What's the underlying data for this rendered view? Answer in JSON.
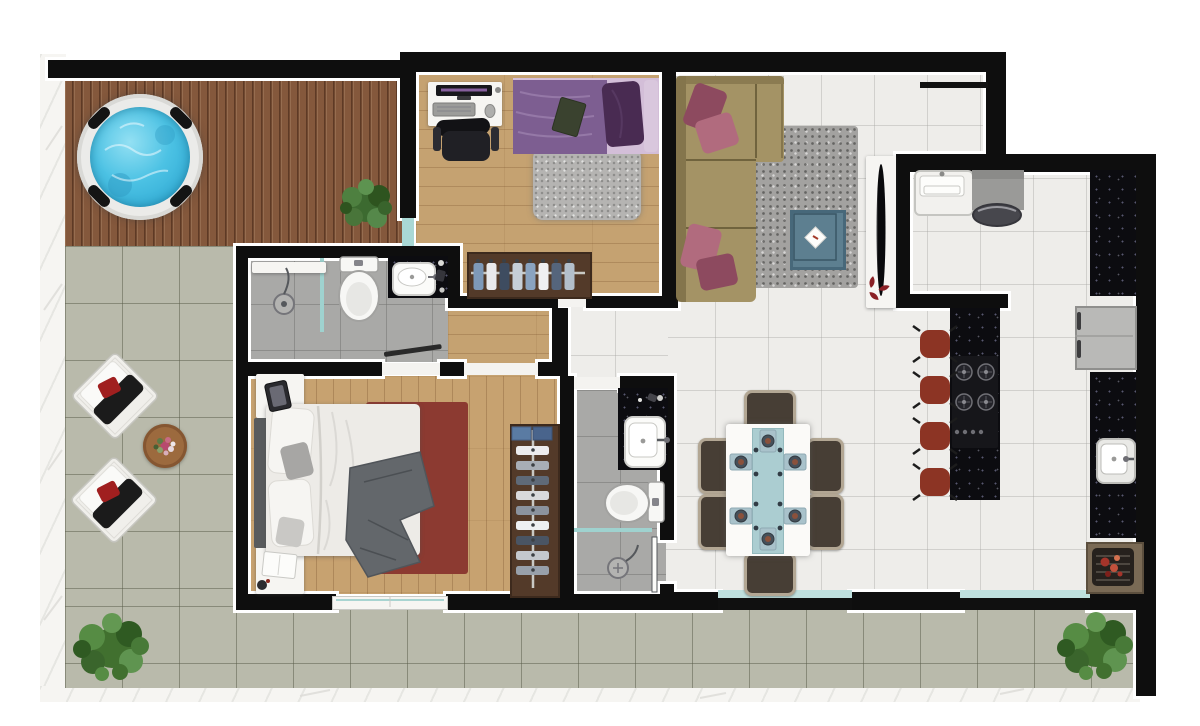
{
  "canvas": {
    "w": 1200,
    "h": 726,
    "background": "#ffffff"
  },
  "palette": {
    "wall": "#0e0e0e",
    "wall_outline": "#ffffff",
    "deck_wood": "#84583c",
    "light_wood": "#c5a271",
    "patio_tile": "#b9baab",
    "white_tile": "#eeedea",
    "gray_tile": "#a9a9a7",
    "granite_counter": "#0c0c10",
    "hot_tub_water": "#4cc2e4",
    "glass_teal": "#9fd2cf",
    "sofa_tan": "#a49365",
    "cushion_maroon": "#8d4a5f",
    "stool_red": "#8c3424",
    "master_rug_red": "#8c3a31",
    "duvet_purple": "#7d5e91",
    "dining_chair_brown": "#473e35",
    "plant_green": "#41702f",
    "coffee_table_blue": "#5d7f90"
  },
  "floors": [
    {
      "n": "left-sill",
      "x": 40,
      "y": 54,
      "w": 26,
      "h": 648,
      "c": "sill"
    },
    {
      "n": "bottom-sill",
      "x": 40,
      "y": 686,
      "w": 1100,
      "h": 16,
      "c": "sill"
    },
    {
      "n": "deck-floor",
      "x": 65,
      "y": 78,
      "w": 338,
      "h": 168,
      "c": "deck"
    },
    {
      "n": "patio-left-floor",
      "x": 65,
      "y": 246,
      "w": 172,
      "h": 362,
      "c": "patio"
    },
    {
      "n": "patio-bottom-floor",
      "x": 65,
      "y": 606,
      "w": 1071,
      "h": 82,
      "c": "patio"
    },
    {
      "n": "living-kitchen-floor",
      "x": 662,
      "y": 72,
      "w": 474,
      "h": 522,
      "c": "tileW"
    },
    {
      "n": "outside-corner",
      "x": 1006,
      "y": 40,
      "w": 154,
      "h": 114,
      "f": "#ffffff"
    },
    {
      "n": "bedroom1-floor",
      "x": 416,
      "y": 72,
      "w": 246,
      "h": 232,
      "c": "woodH"
    },
    {
      "n": "hall-floor",
      "x": 448,
      "y": 296,
      "w": 114,
      "h": 80,
      "c": "woodH"
    },
    {
      "n": "living-strip-floor",
      "x": 562,
      "y": 302,
      "w": 106,
      "h": 76,
      "c": "tileW"
    },
    {
      "n": "bath1-floor",
      "x": 248,
      "y": 258,
      "w": 200,
      "h": 104,
      "c": "tileG"
    },
    {
      "n": "bath2-floor",
      "x": 574,
      "y": 390,
      "w": 92,
      "h": 204,
      "c": "tileG"
    },
    {
      "n": "master-bedroom-floor",
      "x": 248,
      "y": 376,
      "w": 312,
      "h": 218,
      "c": "woodV"
    }
  ],
  "walls": [
    {
      "n": "deck-top-wall",
      "x": 48,
      "y": 60,
      "w": 360,
      "h": 18
    },
    {
      "n": "main-top-wall",
      "x": 400,
      "y": 52,
      "w": 606,
      "h": 20
    },
    {
      "n": "upper-right-wall",
      "x": 986,
      "y": 52,
      "w": 20,
      "h": 112
    },
    {
      "n": "kitchen-top-wall",
      "x": 896,
      "y": 154,
      "w": 260,
      "h": 18
    },
    {
      "n": "right-outer-wall",
      "x": 1136,
      "y": 154,
      "w": 20,
      "h": 542
    },
    {
      "n": "deck-divider-wall",
      "x": 400,
      "y": 60,
      "w": 16,
      "h": 158
    },
    {
      "n": "bath1-top-wall",
      "x": 236,
      "y": 246,
      "w": 224,
      "h": 12
    },
    {
      "n": "bath1-left-wall",
      "x": 236,
      "y": 246,
      "w": 12,
      "h": 128
    },
    {
      "n": "bath1-right-wall",
      "x": 448,
      "y": 246,
      "w": 12,
      "h": 62
    },
    {
      "n": "closet-wall-a",
      "x": 448,
      "y": 296,
      "w": 110,
      "h": 12
    },
    {
      "n": "closet-wall-b",
      "x": 586,
      "y": 296,
      "w": 92,
      "h": 12
    },
    {
      "n": "hall-right-wall",
      "x": 552,
      "y": 308,
      "w": 16,
      "h": 68
    },
    {
      "n": "master-top-wall-a",
      "x": 236,
      "y": 362,
      "w": 146,
      "h": 14
    },
    {
      "n": "master-top-wall-b",
      "x": 440,
      "y": 362,
      "w": 24,
      "h": 14
    },
    {
      "n": "master-top-wall-c",
      "x": 538,
      "y": 362,
      "w": 26,
      "h": 14
    },
    {
      "n": "master-left-wall",
      "x": 236,
      "y": 362,
      "w": 12,
      "h": 248
    },
    {
      "n": "master-bottom-wall-a",
      "x": 236,
      "y": 594,
      "w": 100,
      "h": 16
    },
    {
      "n": "master-bottom-wall-b",
      "x": 446,
      "y": 594,
      "w": 120,
      "h": 16
    },
    {
      "n": "bath2-left-wall",
      "x": 560,
      "y": 376,
      "w": 14,
      "h": 234
    },
    {
      "n": "bath2-top-wall",
      "x": 620,
      "y": 376,
      "w": 54,
      "h": 14
    },
    {
      "n": "bath2-right-wall",
      "x": 660,
      "y": 376,
      "w": 14,
      "h": 164
    },
    {
      "n": "bath2-right-stub",
      "x": 660,
      "y": 584,
      "w": 14,
      "h": 26
    },
    {
      "n": "bath2-bottom-wall",
      "x": 574,
      "y": 594,
      "w": 100,
      "h": 16
    },
    {
      "n": "bedroom1-right-wall",
      "x": 662,
      "y": 52,
      "w": 14,
      "h": 252
    },
    {
      "n": "kitchen-left-wall",
      "x": 896,
      "y": 154,
      "w": 14,
      "h": 154
    },
    {
      "n": "kitchen-nook-wall",
      "x": 896,
      "y": 294,
      "w": 112,
      "h": 14
    },
    {
      "n": "living-bottom-wall-a",
      "x": 662,
      "y": 592,
      "w": 58,
      "h": 18
    },
    {
      "n": "living-bottom-wall-b",
      "x": 850,
      "y": 592,
      "w": 112,
      "h": 18
    },
    {
      "n": "living-bottom-wall-c",
      "x": 1088,
      "y": 592,
      "w": 52,
      "h": 18
    }
  ],
  "glass": [
    {
      "n": "upper-ledge",
      "x": 920,
      "y": 82,
      "w": 68,
      "h": 6,
      "f": "#121212"
    },
    {
      "n": "deck-glass-door",
      "x": 402,
      "y": 218,
      "w": 12,
      "h": 28,
      "f": "#a9d8d5"
    },
    {
      "n": "slider-track-1",
      "x": 718,
      "y": 598,
      "w": 134,
      "h": 12,
      "f": "#101010"
    },
    {
      "n": "slider-glass-1",
      "x": 718,
      "y": 590,
      "w": 134,
      "h": 8,
      "f": "#bfe0de"
    },
    {
      "n": "slider-track-2",
      "x": 960,
      "y": 598,
      "w": 130,
      "h": 12,
      "f": "#101010"
    },
    {
      "n": "slider-glass-2",
      "x": 960,
      "y": 590,
      "w": 130,
      "h": 8,
      "f": "#bfe0de"
    },
    {
      "n": "master-window",
      "x": 332,
      "y": 596,
      "w": 114,
      "h": 12,
      "f": "#f6f5f2",
      "b": "1px solid #c9c9c5"
    },
    {
      "n": "bath1-shower-glass",
      "x": 320,
      "y": 258,
      "w": 4,
      "h": 74,
      "f": "#9fd2cf"
    },
    {
      "n": "bath2-shower-glass",
      "x": 574,
      "y": 528,
      "w": 78,
      "h": 4,
      "f": "#9fd2cf"
    },
    {
      "n": "bedroom1-door-threshold",
      "x": 558,
      "y": 297,
      "w": 28,
      "h": 10,
      "f": "#f4f3f0"
    },
    {
      "n": "master-door-threshold",
      "x": 464,
      "y": 363,
      "w": 74,
      "h": 12,
      "f": "#f4f3f0"
    },
    {
      "n": "bath1-door-threshold",
      "x": 382,
      "y": 363,
      "w": 58,
      "h": 12,
      "f": "#f4f3f0"
    },
    {
      "n": "bath2-door-threshold",
      "x": 574,
      "y": 377,
      "w": 46,
      "h": 12,
      "f": "#f4f3f0"
    }
  ],
  "furniture": [
    {
      "n": "living-rug",
      "x": 746,
      "y": 126,
      "w": 112,
      "h": 162,
      "c": "rugL"
    },
    {
      "n": "sofa-body",
      "x": 676,
      "y": 76,
      "w": 80,
      "h": 226,
      "f": "#a49365",
      "r": 6
    },
    {
      "n": "sofa-chaise",
      "x": 676,
      "y": 76,
      "w": 108,
      "h": 86,
      "f": "#a49365",
      "r": 4
    },
    {
      "n": "coffee-table",
      "x": 790,
      "y": 210,
      "w": 50,
      "h": 54,
      "f": "#5d7f90",
      "b": "3px solid #47687a"
    },
    {
      "n": "tv-console",
      "x": 866,
      "y": 156,
      "w": 30,
      "h": 152,
      "c": "whitebox"
    },
    {
      "n": "hottub-rim",
      "x": 77,
      "y": 94,
      "w": 126,
      "h": 126,
      "r": "50%",
      "f": "#ebebe9",
      "sh": "0 0 8px rgba(60,60,60,.5), inset 0 0 0 4px #d9d9d6"
    },
    {
      "n": "hottub-water",
      "x": 90,
      "y": 107,
      "w": 100,
      "h": 100,
      "r": "50%",
      "c": "water"
    },
    {
      "n": "desk",
      "x": 428,
      "y": 82,
      "w": 74,
      "h": 44,
      "c": "whitebox"
    },
    {
      "n": "bedroom1-rug",
      "x": 533,
      "y": 148,
      "w": 108,
      "h": 72,
      "c": "rug1"
    },
    {
      "n": "bed1-base",
      "x": 513,
      "y": 78,
      "w": 146,
      "h": 76,
      "f": "#d3bed8"
    },
    {
      "n": "bed1-duvet",
      "x": 513,
      "y": 80,
      "w": 94,
      "h": 74,
      "f": "#7d5e91"
    },
    {
      "n": "bed1-pillow",
      "x": 604,
      "y": 82,
      "w": 38,
      "h": 64,
      "f": "#492b52",
      "r": 7,
      "rot": -5
    },
    {
      "n": "bed1-edge-pillow",
      "x": 644,
      "y": 80,
      "w": 14,
      "h": 72,
      "f": "#d9c7dd",
      "r": 4
    },
    {
      "n": "bedroom1-closet",
      "x": 467,
      "y": 252,
      "w": 121,
      "h": 43,
      "f": "#533a29",
      "b": "2px solid #3d2a1d"
    },
    {
      "n": "bath1-shelf",
      "x": 252,
      "y": 262,
      "w": 74,
      "h": 11,
      "c": "whitebox"
    },
    {
      "n": "bath1-counter",
      "x": 388,
      "y": 256,
      "w": 60,
      "h": 42,
      "c": "granite"
    },
    {
      "n": "bath1-sink",
      "x": 392,
      "y": 262,
      "w": 40,
      "h": 30,
      "f": "#fbfbf9",
      "r": 8,
      "b": "2px solid #cfcfcc"
    },
    {
      "n": "nightstand-1",
      "x": 256,
      "y": 374,
      "w": 48,
      "h": 44,
      "c": "whitebox"
    },
    {
      "n": "nightstand-2",
      "x": 256,
      "y": 546,
      "w": 48,
      "h": 48,
      "c": "whitebox"
    },
    {
      "n": "master-rug",
      "x": 366,
      "y": 402,
      "w": 102,
      "h": 172,
      "f": "#8c3a31",
      "r": 3
    },
    {
      "n": "bed2-headboard",
      "x": 254,
      "y": 418,
      "w": 14,
      "h": 130,
      "f": "#595b5d",
      "r": 2
    },
    {
      "n": "bed2-mattress",
      "x": 266,
      "y": 404,
      "w": 154,
      "h": 152,
      "f": "#edebe7",
      "r": 5,
      "sh": "0 1px 4px rgba(80,80,80,.5)"
    },
    {
      "n": "master-closet",
      "x": 510,
      "y": 424,
      "w": 46,
      "h": 170,
      "f": "#533a29",
      "b": "2px solid #3d2a1d"
    },
    {
      "n": "bath2-counter",
      "x": 618,
      "y": 388,
      "w": 50,
      "h": 82,
      "c": "granite"
    },
    {
      "n": "bath2-sink",
      "x": 624,
      "y": 416,
      "w": 38,
      "h": 48,
      "f": "#fbfbf9",
      "r": 9,
      "b": "2px solid #cfcfcc"
    },
    {
      "n": "dining-chair-top",
      "x": 744,
      "y": 390,
      "w": 46,
      "h": 38,
      "c": "dchair"
    },
    {
      "n": "dining-chair-bottom",
      "x": 744,
      "y": 552,
      "w": 46,
      "h": 38,
      "c": "dchair"
    },
    {
      "n": "dining-chair-left-1",
      "x": 698,
      "y": 438,
      "w": 32,
      "h": 50,
      "c": "dchair"
    },
    {
      "n": "dining-chair-left-2",
      "x": 698,
      "y": 494,
      "w": 32,
      "h": 50,
      "c": "dchair"
    },
    {
      "n": "dining-chair-right-1",
      "x": 806,
      "y": 438,
      "w": 32,
      "h": 50,
      "c": "dchair"
    },
    {
      "n": "dining-chair-right-2",
      "x": 806,
      "y": 494,
      "w": 32,
      "h": 50,
      "c": "dchair"
    },
    {
      "n": "dining-table",
      "x": 726,
      "y": 424,
      "w": 84,
      "h": 132,
      "f": "#fbfaf8",
      "r": 3,
      "sh": "0 0 6px rgba(90,90,90,.55)"
    },
    {
      "n": "table-runner",
      "x": 752,
      "y": 428,
      "w": 30,
      "h": 124,
      "f": "#abcdd1",
      "b": "1px solid #93b9bd"
    },
    {
      "n": "kitchen-sink-unit",
      "x": 914,
      "y": 170,
      "w": 56,
      "h": 42,
      "f": "#f2f1ee",
      "r": 6,
      "b": "2px solid #c5c5c1"
    },
    {
      "n": "kitchen-appliance",
      "x": 972,
      "y": 170,
      "w": 52,
      "h": 40,
      "f": "#9a9a98"
    },
    {
      "n": "counter-top-right",
      "x": 1090,
      "y": 170,
      "w": 46,
      "h": 126,
      "c": "granite"
    },
    {
      "n": "fridge",
      "x": 1075,
      "y": 306,
      "w": 58,
      "h": 60,
      "f": "#b9b9b7",
      "b": "2px solid #8f8f8d"
    },
    {
      "n": "counter-right",
      "x": 1090,
      "y": 372,
      "w": 46,
      "h": 166,
      "c": "granite"
    },
    {
      "n": "grill-surround",
      "x": 1086,
      "y": 542,
      "w": 54,
      "h": 48,
      "f": "#7a6a55",
      "b": "2px solid #5c4f3e"
    },
    {
      "n": "grill",
      "x": 1092,
      "y": 548,
      "w": 42,
      "h": 38,
      "f": "#26211d",
      "r": 5
    },
    {
      "n": "kitchen-island",
      "x": 950,
      "y": 308,
      "w": 50,
      "h": 192,
      "c": "granite"
    },
    {
      "n": "bar-stool-1",
      "x": 920,
      "y": 330,
      "w": 30,
      "h": 28,
      "f": "#8c3424",
      "r": 9
    },
    {
      "n": "bar-stool-2",
      "x": 920,
      "y": 376,
      "w": 30,
      "h": 28,
      "f": "#8c3424",
      "r": 9
    },
    {
      "n": "bar-stool-3",
      "x": 920,
      "y": 422,
      "w": 30,
      "h": 28,
      "f": "#8c3424",
      "r": 9
    },
    {
      "n": "bar-stool-4",
      "x": 920,
      "y": 468,
      "w": 30,
      "h": 28,
      "f": "#8c3424",
      "r": 9
    },
    {
      "n": "kitchen-sink-2",
      "x": 1096,
      "y": 438,
      "w": 36,
      "h": 42,
      "f": "#e9e9e6",
      "r": 8,
      "b": "2px solid #bcbcb8"
    },
    {
      "n": "patio-side-table",
      "x": 143,
      "y": 424,
      "w": 44,
      "h": 44,
      "r": "50%",
      "f": "#9c6a3e",
      "sh": "inset 0 0 0 3px #855631, 0 1px 3px rgba(80,80,70,.6)"
    }
  ]
}
